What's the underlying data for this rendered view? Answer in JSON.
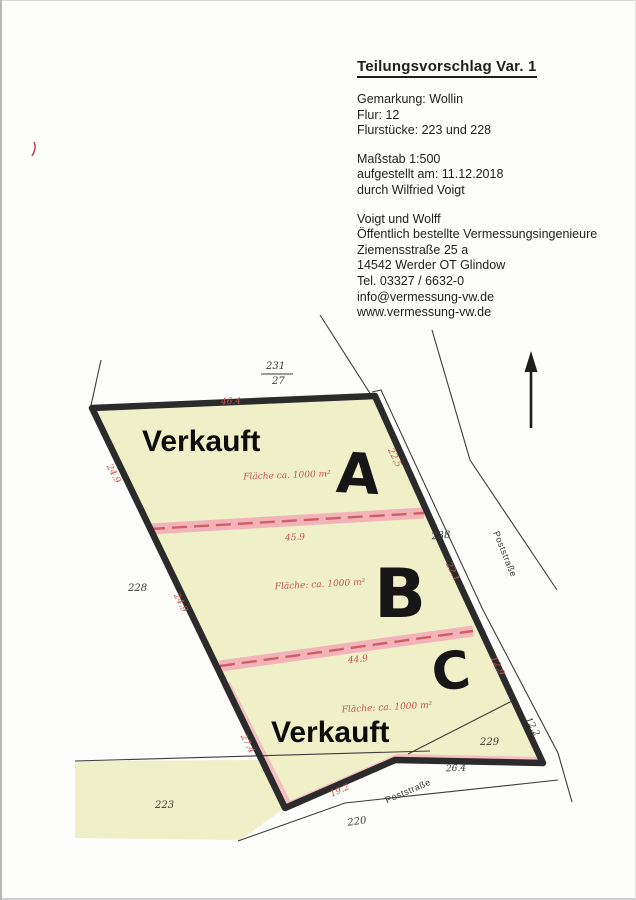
{
  "document": {
    "title": "Teilungsvorschlag Var. 1",
    "info_lines": [
      "Gemarkung: Wollin",
      "Flur: 12",
      "Flurstücke: 223 und 228"
    ],
    "scale_lines": [
      "Maßstab 1:500",
      "aufgestellt am: 11.12.2018",
      "durch Wilfried Voigt"
    ],
    "office_lines": [
      "Voigt und Wolff",
      "Öffentlich bestellte Vermessungsingenieure",
      "Ziemensstraße 25 a",
      "14542 Werder OT Glindow",
      "Tel. 03327 / 6632-0",
      "info@vermessung-vw.de",
      "www.vermessung-vw.de"
    ]
  },
  "plan": {
    "north_arrow_icon": "north-arrow",
    "labels": {
      "verkauft_top": "Verkauft",
      "verkauft_bottom": "Verkauft",
      "lot_a": "A",
      "lot_b": "B",
      "lot_c": "C",
      "area_a": "Fläche ca. 1000 m²",
      "area_b": "Fläche: ca. 1000 m²",
      "area_c": "Fläche: ca. 1000 m²",
      "street_right": "Poststraße",
      "street_bottom": "Poststraße",
      "parcel_228": "228",
      "parcel_223": "223",
      "parcel_220": "220",
      "parcel_229": "229",
      "parcel_238": "238",
      "parcel_fraction_numerator": "231",
      "parcel_fraction_denominator": "27",
      "dim_top_a": "46.4",
      "dim_mid_b": "45.9",
      "dim_mid_c": "44.9",
      "dim_west_a": "24.9",
      "dim_west_b": "24.9",
      "dim_west_c": "27.4",
      "dim_east_a": "22.5",
      "dim_east_b": "22.1",
      "dim_east_c": "12.9",
      "dim_east_road": "12.2",
      "dim_bottom": "26.4",
      "dim_bottom_left": "19.2"
    }
  },
  "colors": {
    "parcel_fill": "#eff0c8",
    "divider_band": "#f2b4b8",
    "divider_dash": "#cf5f66",
    "boundary": "#2b2b2b",
    "dimension_red": "#c7564e"
  }
}
